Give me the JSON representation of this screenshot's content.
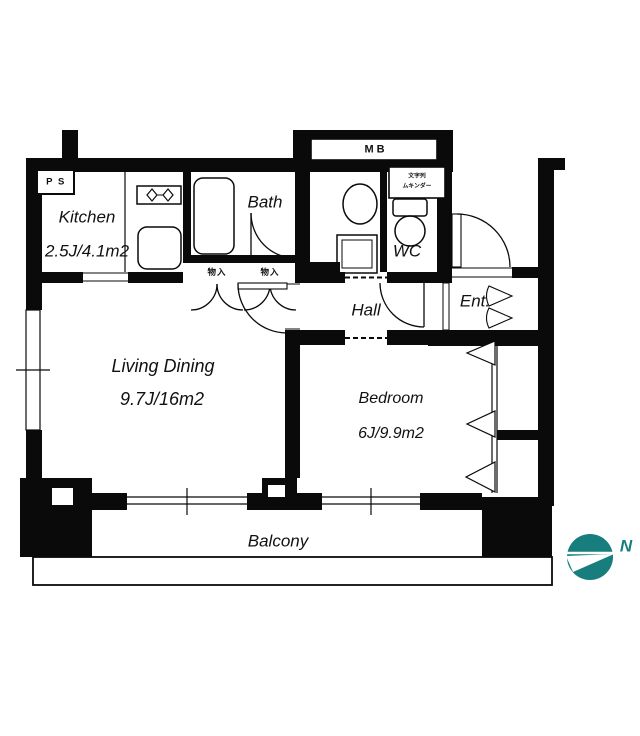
{
  "floor_plan": {
    "rooms": {
      "kitchen": {
        "label": "Kitchen",
        "size": "2.5J/4.1m2"
      },
      "bath": {
        "label": "Bath"
      },
      "wc": {
        "label": "WC"
      },
      "hall": {
        "label": "Hall"
      },
      "entrance": {
        "label": "Ent."
      },
      "living_dining": {
        "label": "Living Dining",
        "size": "9.7J/16m2"
      },
      "bedroom": {
        "label": "Bedroom",
        "size": "6J/9.9m2"
      },
      "balcony": {
        "label": "Balcony"
      }
    },
    "annotations": {
      "meter_box": "MB",
      "pipe_space": "P S",
      "storage_left": "物入",
      "storage_right": "物入",
      "wc_cabinet_line1": "文字列",
      "wc_cabinet_line2": "ムキンダー"
    },
    "compass": {
      "label": "N",
      "color": "#177d7d"
    },
    "colors": {
      "walls": "#0a0a0a",
      "background": "#ffffff",
      "accent": "#177d7d"
    },
    "icons": [
      "stove-burners-icon",
      "kitchen-sink-icon",
      "bathtub-icon",
      "washbasin-icon",
      "washing-machine-icon",
      "toilet-icon",
      "compass-icon"
    ]
  }
}
